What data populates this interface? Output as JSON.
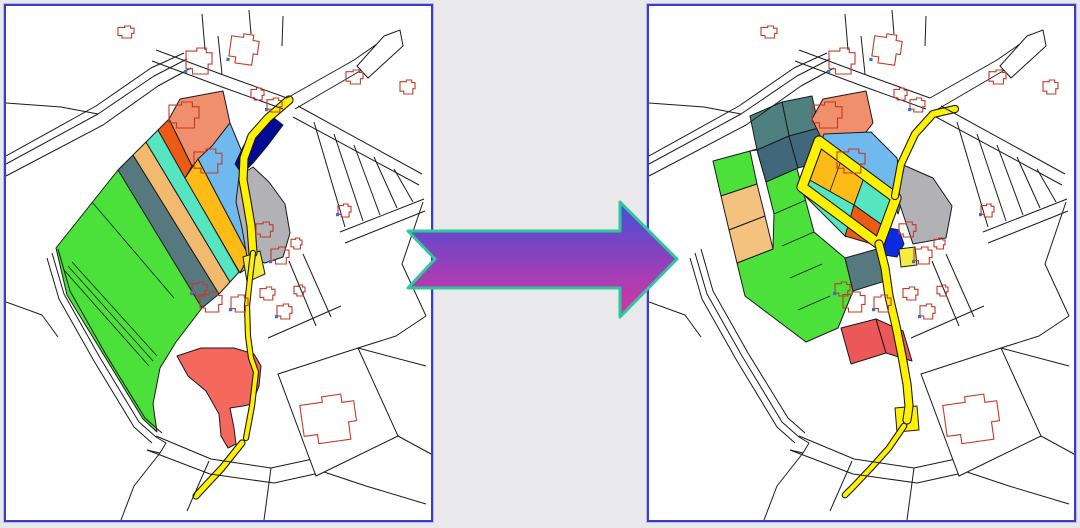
{
  "colors": {
    "bg": "#E9E9EB",
    "panel_bg": "#FFFFFF",
    "panel_border": "#3C3CC8",
    "panel_halo": "#B9B9E8",
    "line": "#1A1A1A",
    "building": "#C23B27",
    "mark": "#3A6FD8",
    "green": "#4CE03A",
    "slate": "#55797F",
    "teal_light": "#4E8080",
    "teal_dark": "#41687A",
    "sandy": "#F1BA6F",
    "tan": "#F2C27E",
    "turquoise": "#55E6C1",
    "amber": "#FCBB16",
    "lightblue": "#6FB9EE",
    "orangered": "#EB5B15",
    "salmon": "#EF8F6C",
    "navy_left": "#000A96",
    "navy_right": "#0A2AE3",
    "gray": "#B2B2B6",
    "road_yellow": "#FFF100",
    "yellow_parcel": "#F4EC3F",
    "red_blob": "#F4685E",
    "red_parcel": "#EC5858",
    "white": "#FFFFFF"
  },
  "arrow": {
    "points": "8,41 220,41 220,12 277,69 220,127 220,98 8,98 35,69",
    "gradient_top": "#4150D8",
    "gradient_bottom": "#DC33A2",
    "outline": "#2EC79E"
  },
  "base_map": {
    "roads": [
      "0,150 90,100 145,62 178,47",
      "0,158 92,108 148,70 181,53",
      "0,170 97,119 152,80 185,62",
      "0,97 55,101 92,108",
      "46,247 58,288 93,350 133,416 150,431",
      "52,243 64,285 99,347 139,412 156,427",
      "41,252 53,293 88,355 128,421 146,437",
      "150,44 220,70 281,92",
      "146,55 216,81 277,103",
      "281,92 348,54 381,31",
      "289,103 354,65 391,44",
      "292,100 416,168",
      "287,111 413,179",
      "308,116 339,221",
      "328,128 357,215",
      "348,139 374,209",
      "368,151 391,202",
      "388,163 407,196",
      "334,226 418,193",
      "339,237 419,205",
      "283,255 310,320",
      "297,248 325,311",
      "262,332 335,300",
      "417,196 396,258 420,310",
      "420,310 390,330 352,342",
      "352,342 420,360",
      "392,430 425,448",
      "150,430 205,453 265,462 316,451",
      "141,444 204,468 268,477 318,466",
      "316,451 352,442 392,430",
      "318,466 360,480 420,498",
      "265,462 258,514",
      "203,455 181,505",
      "150,431 160,437 154,447 141,444",
      "154,447 128,480 115,514",
      "196,8 199,44",
      "243,4 245,28",
      "277,10 276,40",
      "212,30 216,68",
      "0,296 36,309 52,331"
    ],
    "outline_polygons": [
      "378,30 394,24 397,40 362,72 351,60",
      "272,368 352,342 392,430 310,470"
    ],
    "buildings": [
      {
        "x": 112,
        "y": 20,
        "w": 16,
        "h": 12
      },
      {
        "x": 180,
        "y": 42,
        "w": 26,
        "h": 26,
        "m": 1
      },
      {
        "x": 224,
        "y": 28,
        "w": 28,
        "h": 30,
        "r": 8,
        "m": 1
      },
      {
        "x": 245,
        "y": 82,
        "w": 13,
        "h": 12
      },
      {
        "x": 261,
        "y": 92,
        "w": 15,
        "h": 14,
        "m": 1
      },
      {
        "x": 340,
        "y": 64,
        "w": 17,
        "h": 14
      },
      {
        "x": 394,
        "y": 74,
        "w": 15,
        "h": 14
      },
      {
        "x": 332,
        "y": 198,
        "w": 13,
        "h": 13,
        "m": 1
      },
      {
        "x": 250,
        "y": 216,
        "w": 17,
        "h": 15
      },
      {
        "x": 265,
        "y": 241,
        "w": 18,
        "h": 17,
        "m": 1
      },
      {
        "x": 285,
        "y": 232,
        "w": 11,
        "h": 11
      },
      {
        "x": 194,
        "y": 286,
        "w": 22,
        "h": 20
      },
      {
        "x": 225,
        "y": 289,
        "w": 17,
        "h": 17,
        "m": 1
      },
      {
        "x": 254,
        "y": 281,
        "w": 15,
        "h": 13
      },
      {
        "x": 271,
        "y": 298,
        "w": 15,
        "h": 15,
        "m": 1
      },
      {
        "x": 288,
        "y": 279,
        "w": 11,
        "h": 11
      },
      {
        "x": 296,
        "y": 390,
        "w": 54,
        "h": 46,
        "r": -8
      },
      {
        "x": 163,
        "y": 96,
        "w": 30,
        "h": 26
      },
      {
        "x": 188,
        "y": 143,
        "w": 28,
        "h": 24
      },
      {
        "x": 186,
        "y": 276,
        "w": 15,
        "h": 14,
        "m": 1
      }
    ]
  },
  "left_map": {
    "parcels": [
      {
        "id": "green-strips",
        "c": "green",
        "pts": "50,242 112,164 204,259 196,302 170,336 154,362 147,398 151,426 137,413 99,351 61,289"
      },
      {
        "id": "slate-strip",
        "c": "slate",
        "pts": "112,164 127,149 213,288 196,302"
      },
      {
        "id": "sandy-strip",
        "c": "sandy",
        "pts": "127,149 140,136 224,276 213,288"
      },
      {
        "id": "turquoise-strip",
        "c": "turquoise",
        "pts": "140,136 152,124 233,266 224,276"
      },
      {
        "id": "orangered-strip",
        "c": "orangered",
        "pts": "152,124 163,113 186,160 179,172"
      },
      {
        "id": "salmon-parcel",
        "c": "salmon",
        "pts": "163,113 174,93 217,85 224,117 206,140 186,160"
      },
      {
        "id": "amber-strip",
        "c": "amber",
        "pts": "179,172 192,153 243,250 234,267"
      },
      {
        "id": "blue-strip",
        "c": "lightblue",
        "pts": "192,153 206,140 224,117 236,146 243,186 247,248 240,263 234,267 243,250"
      },
      {
        "id": "navy-parcel",
        "c": "navy_left",
        "pts": "229,158 238,139 252,123 268,112 277,119 262,139 247,157 236,168"
      },
      {
        "id": "gray-parcel",
        "c": "gray",
        "pts": "233,170 247,161 263,176 279,198 284,227 277,251 259,257 241,251 236,222 230,196"
      },
      {
        "id": "yellow-parcel",
        "c": "yellow_parcel",
        "pts": "237,251 254,245 259,268 241,276"
      },
      {
        "id": "red-blob",
        "c": "red_blob",
        "pts": "171,350 195,342 228,342 248,348 255,360 253,380 246,398 237,400 224,402 228,422 230,438 222,442 215,430 213,408 200,385 182,370"
      }
    ],
    "lines": [
      "58,264 143,360",
      "62,260 147,355",
      "66,256 151,350",
      "86,196 168,292"
    ],
    "roads": [
      {
        "pts": "283,94 262,112 246,130 238,152 237,174 241,196 245,220 247,247",
        "w": 7
      },
      {
        "pts": "247,247 244,272 241,300 242,330 245,352 250,366 246,400 240,432",
        "w": 4
      },
      {
        "pts": "236,437 216,462 202,477 190,490",
        "w": 5
      }
    ]
  },
  "right_map": {
    "parcels": [
      {
        "id": "green-area",
        "c": "green",
        "pts": "101,145 140,134 153,181 165,226 196,252 204,285 189,322 157,336 96,290 88,257 124,243 125,208 117,176 108,144"
      },
      {
        "id": "teal-sq-1",
        "c": "teal_light",
        "pts": "133,96 163,90 170,122 140,130"
      },
      {
        "id": "teal-sq-2",
        "c": "teal_light",
        "pts": "101,110 133,96 140,130 108,144"
      },
      {
        "id": "teal-sq-3",
        "c": "teal_dark",
        "pts": "108,144 140,130 149,162 117,176"
      },
      {
        "id": "teal-sq-4",
        "c": "teal_dark",
        "pts": "140,130 170,122 178,154 149,162"
      },
      {
        "id": "salmon-parcel",
        "c": "salmon",
        "pts": "163,113 174,93 217,85 224,117 206,140 186,160"
      },
      {
        "id": "green-w1",
        "c": "green",
        "pts": "64,155 101,145 108,178 72,190"
      },
      {
        "id": "tan-w1",
        "c": "tan",
        "pts": "72,190 108,178 116,210 80,224"
      },
      {
        "id": "tan-w2",
        "c": "tan",
        "pts": "80,224 116,210 124,243 88,257"
      },
      {
        "id": "blue-parcel",
        "c": "lightblue",
        "pts": "175,128 222,126 248,152 254,190 249,208 244,192 172,136"
      },
      {
        "id": "amber-cells",
        "c": "amber",
        "pts": "170,135 216,169 205,199 157,172"
      },
      {
        "id": "turq-ne",
        "c": "turquoise",
        "pts": "216,169 247,192 236,221 205,199"
      },
      {
        "id": "turq-sw",
        "c": "turquoise",
        "pts": "157,172 205,199 197,231 150,184"
      },
      {
        "id": "orangered-cell",
        "c": "orangered",
        "pts": "205,199 236,221 230,240 196,230"
      },
      {
        "id": "slate-sq",
        "c": "slate",
        "pts": "196,252 228,243 236,275 204,285"
      },
      {
        "id": "red-1",
        "c": "red_parcel",
        "pts": "192,322 227,313 237,347 202,358"
      },
      {
        "id": "red-2",
        "c": "red_parcel",
        "pts": "227,313 254,325 263,355 237,347"
      },
      {
        "id": "gray-parcel",
        "c": "gray",
        "pts": "252,158 284,172 303,200 297,232 264,238 250,196"
      },
      {
        "id": "navy-parcel",
        "c": "navy_right",
        "pts": "235,221 250,224 255,238 248,251 235,249 230,235"
      },
      {
        "id": "yellow-sq",
        "c": "yellow_parcel",
        "pts": "250,243 266,241 268,259 252,261"
      },
      {
        "id": "road-block",
        "c": "road_yellow",
        "pts": "246,402 268,400 270,424 248,426"
      }
    ],
    "lines": [
      "125,208 157,194",
      "133,240 165,226",
      "141,272 173,258",
      "149,304 181,290",
      "193,152 181,185"
    ],
    "roads": [
      {
        "pts": "170,135 247,192 230,238 153,181",
        "w": 9,
        "closed": 1
      },
      {
        "pts": "246,190 252,158 266,128 284,108 306,103",
        "w": 6
      },
      {
        "pts": "230,238 236,262 240,290 247,320 253,350 258,378 260,400 258,414",
        "w": 7
      },
      {
        "pts": "255,420 240,442 222,462 205,480 196,489",
        "w": 4.5
      }
    ]
  }
}
